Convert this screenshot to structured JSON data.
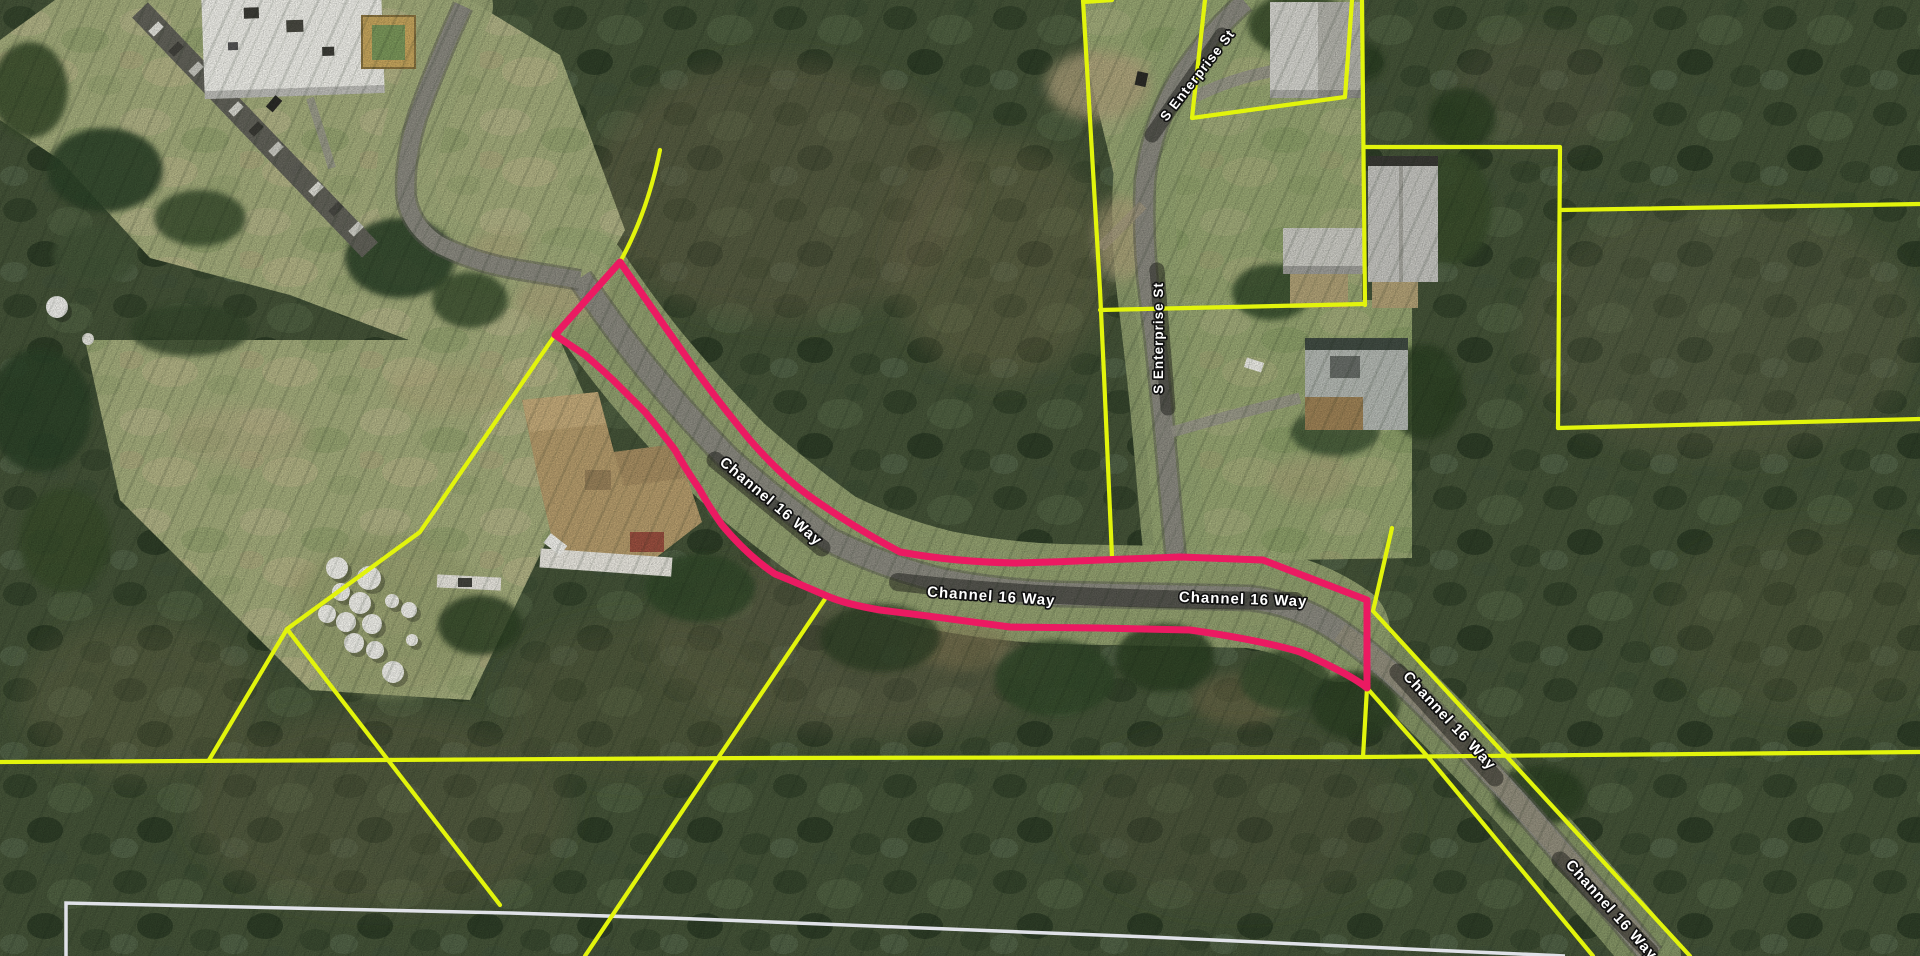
{
  "map": {
    "description_visible_content": "aerial parcel map",
    "labels": [
      {
        "id": "channel-16-way-1",
        "text": "Channel 16 Way"
      },
      {
        "id": "channel-16-way-2",
        "text": "Channel 16 Way"
      },
      {
        "id": "channel-16-way-3",
        "text": "Channel 16 Way"
      },
      {
        "id": "channel-16-way-4",
        "text": "Channel 16 Way"
      },
      {
        "id": "channel-16-way-5",
        "text": "Channel 16 Way"
      },
      {
        "id": "s-enterprise-st-1",
        "text": "S Enterprise St"
      },
      {
        "id": "s-enterprise-st-2",
        "text": "S Enterprise St"
      }
    ],
    "colors": {
      "parcel_boundary_yellow": "#e2f40c",
      "selected_parcel_pink": "#eb1a62",
      "subdivision_boundary_white": "#e9eaf2",
      "road_surface_gray": "#8d8c82",
      "label_text": "#ffffff",
      "label_halo": "#101010"
    }
  }
}
